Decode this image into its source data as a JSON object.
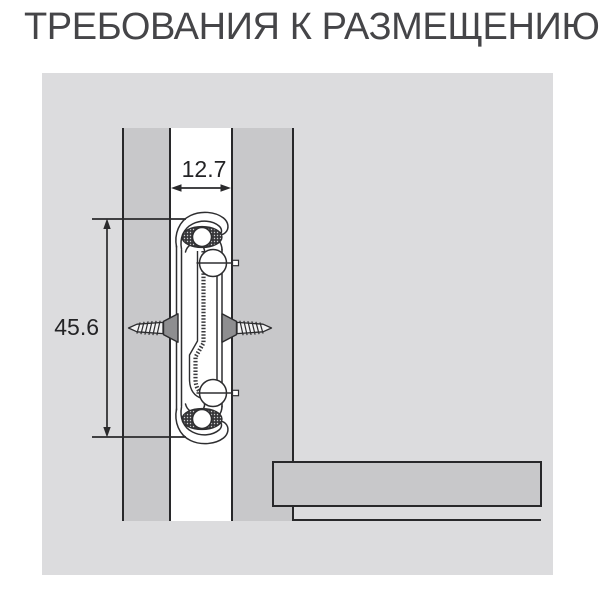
{
  "title": "ТРЕБОВАНИЯ К РАЗМЕЩЕНИЮ",
  "diagram": {
    "gap_width_label": "12.7",
    "slide_height_label": "45.6",
    "icons": {
      "left_screw": "countersunk-screw-pointing-left",
      "right_screw": "countersunk-screw-pointing-right"
    },
    "colors": {
      "page_background": "#ffffff",
      "panel_background": "#dcdcde",
      "wood_panel": "#c8c8ca",
      "drawing_line": "#2c2c2e",
      "screw_head": "#8e8e90",
      "title_text": "#454548",
      "dimension_text": "#232325"
    }
  }
}
